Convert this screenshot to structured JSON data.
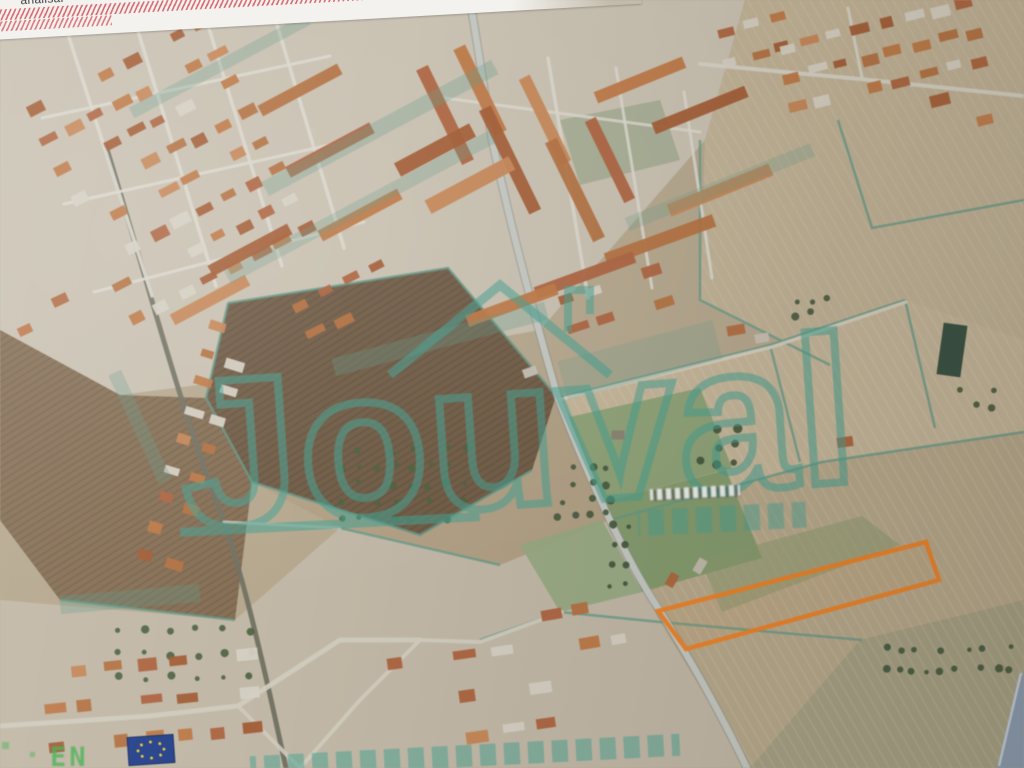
{
  "screen": {
    "toolbar_label": "analisar"
  },
  "watermark": {
    "brand": "Jouval",
    "color": "#3fa392",
    "subtext_legible": false,
    "bottom_row_legible": false
  },
  "map": {
    "corner_mark": "EN",
    "street_label_legible": false,
    "parcel": {
      "points": "658,611 926,542 939,580 686,649",
      "color": "#f5801e"
    },
    "eu_flag": {
      "fill": "#23408f",
      "stars": "#f7d22a"
    },
    "palette": {
      "roofs": [
        "#b0613a",
        "#c1763f",
        "#a55a2f",
        "#c98551",
        "#b66f3b"
      ],
      "light": "#d7d1c3"
    },
    "fields": [
      {
        "points": "0,0 1024,0 1024,768 0,768",
        "fill": "#b7a88c"
      },
      {
        "points": "0,0 745,0 705,140 540,330 330,368 120,395 0,330",
        "fill": "#cbc2b1"
      },
      {
        "points": "745,0 1024,0 1024,340 830,365 700,300 705,140",
        "fill": "#c2b294",
        "pat": "furrows2"
      },
      {
        "points": "252,482 340,528 500,565 610,520 556,396 448,268 228,303 206,398",
        "fill": "#b2a083"
      },
      {
        "points": "228,303 448,268 556,396 532,470 420,535 252,482 206,398",
        "fill": "#6f5a42",
        "pat": "furrows"
      },
      {
        "points": "0,330 120,395 206,398 252,482 235,620 60,600 0,520",
        "fill": "#856c50",
        "pat": "furrows"
      },
      {
        "points": "556,396 770,345 905,300 1024,340 1024,432 822,462 610,520",
        "fill": "#c7b798",
        "pat": "furrows2"
      },
      {
        "points": "610,520 822,462 1024,432 1024,600 860,640 750,768 660,622",
        "fill": "#baa98a",
        "pat": "furrows2"
      },
      {
        "points": "0,600 235,620 340,528 500,565 610,520 660,622 750,768 0,768",
        "fill": "#c3b9a6"
      },
      {
        "points": "860,640 1024,600 1024,768 750,768",
        "fill": "#a8a183",
        "pat": "furrows2"
      }
    ],
    "greens": [
      {
        "points": "565,418 700,388 732,468 602,502",
        "fill": "#8ba173",
        "o": 0.95
      },
      {
        "points": "602,502 726,470 762,558 642,592",
        "fill": "#7f9a69",
        "o": 0.95
      },
      {
        "points": "520,545 602,520 642,592 560,612",
        "fill": "#95aa7e",
        "o": 0.9
      },
      {
        "points": "700,560 862,516 900,545 722,612",
        "fill": "#8a9b6d",
        "o": 0.55
      },
      {
        "points": "560,120 660,100 680,160 580,185",
        "fill": "#7e9a70",
        "o": 0.45
      }
    ],
    "hedges": [
      "228,303 448,268 556,396",
      "228,303 206,398 252,482 420,535 532,470",
      "610,520 822,462 1024,432",
      "556,398 770,345 905,300",
      "770,345 800,462",
      "905,300 935,428",
      "700,140 700,300 830,365",
      "660,622 862,640",
      "340,528 500,565",
      "60,600 235,620",
      "480,640 560,612 660,622",
      "1024,200 872,228 838,120"
    ],
    "roads": [
      {
        "d": "M470,0 C480,60 486,100 492,140 C512,232 536,322 558,398 C586,472 626,560 658,608 C692,662 720,712 747,768",
        "w": 9,
        "c": "#8d9189",
        "o": 0.55
      },
      {
        "d": "M470,0 C480,60 486,100 492,140 C512,232 536,322 558,398 C586,472 626,560 658,608 C692,662 720,712 747,768",
        "w": 6.5,
        "c": "#c6c9c3",
        "o": 1
      },
      {
        "d": "M106,146 C142,262 178,402 224,522 C243,578 258,642 272,704 L286,768",
        "w": 5,
        "c": "#70705f",
        "o": 0.95
      },
      {
        "d": "M558,400 L772,347 L906,302",
        "w": 3.5,
        "c": "#d8d2c2",
        "o": 0.9
      },
      {
        "d": "M0,726 L150,716 L238,706 L340,640 L420,640",
        "w": 5,
        "c": "#d2ccbe",
        "o": 0.95
      },
      {
        "d": "M420,640 L480,642 L562,612",
        "w": 4,
        "c": "#d2ccbe",
        "o": 0.95
      },
      {
        "d": "M300,768 L360,700 L420,640",
        "w": 4,
        "c": "#d2ccbe",
        "o": 0.95
      },
      {
        "d": "M238,706 L300,768",
        "w": 4,
        "c": "#d2ccbe",
        "o": 0.9
      },
      {
        "d": "M700,64 L870,80 L1024,96",
        "w": 4,
        "c": "#d8d4c8",
        "o": 0.9
      },
      {
        "d": "M862,78 L848,8",
        "w": 3,
        "c": "#d8d4c8",
        "o": 0.9
      },
      {
        "d": "M66,28 L152,296",
        "w": 3.5,
        "c": "#ddd9ce",
        "o": 0.9
      },
      {
        "d": "M134,18 L216,286",
        "w": 3.5,
        "c": "#ddd9ce",
        "o": 0.9
      },
      {
        "d": "M204,12 L282,266",
        "w": 3.5,
        "c": "#ddd9ce",
        "o": 0.9
      },
      {
        "d": "M272,8 L344,248",
        "w": 3.5,
        "c": "#ddd9ce",
        "o": 0.9
      },
      {
        "d": "M42,118 L330,56",
        "w": 3,
        "c": "#ddd9ce",
        "o": 0.9
      },
      {
        "d": "M64,204 L352,140",
        "w": 3,
        "c": "#ddd9ce",
        "o": 0.9
      },
      {
        "d": "M94,292 L364,222",
        "w": 3,
        "c": "#ddd9ce",
        "o": 0.9
      },
      {
        "d": "M548,58 L588,298",
        "w": 3.5,
        "c": "#ddd9ce",
        "o": 0.9
      },
      {
        "d": "M616,68 L652,288",
        "w": 3,
        "c": "#ddd9ce",
        "o": 0.9
      },
      {
        "d": "M684,92 L712,278",
        "w": 3,
        "c": "#ddd9ce",
        "o": 0.9
      },
      {
        "d": "M430,96 L700,132",
        "w": 3,
        "c": "#ddd9ce",
        "o": 0.85
      },
      {
        "d": "M224,522 L340,528",
        "w": 3,
        "c": "#cfcabc",
        "o": 0.85
      }
    ],
    "groves": [
      {
        "x": 340,
        "y": 450,
        "cols": 8,
        "rows": 5,
        "dx": 18,
        "dy": 17,
        "r": 2.8,
        "fill": "#4a5f3a"
      },
      {
        "x": 560,
        "y": 470,
        "cols": 4,
        "rows": 4,
        "dx": 16,
        "dy": 15,
        "r": 3.2,
        "fill": "#41573a"
      },
      {
        "x": 885,
        "y": 648,
        "cols": 10,
        "rows": 2,
        "dx": 14,
        "dy": 22,
        "r": 3,
        "fill": "#3f5638"
      },
      {
        "x": 120,
        "y": 630,
        "cols": 6,
        "rows": 3,
        "dx": 26,
        "dy": 24,
        "r": 3,
        "fill": "#47603c"
      },
      {
        "x": 700,
        "y": 430,
        "cols": 3,
        "rows": 3,
        "dx": 18,
        "dy": 16,
        "r": 3.5,
        "fill": "#3e5336"
      },
      {
        "x": 960,
        "y": 390,
        "cols": 3,
        "rows": 2,
        "dx": 16,
        "dy": 16,
        "r": 3,
        "fill": "#44563b"
      },
      {
        "x": 612,
        "y": 525,
        "cols": 2,
        "rows": 4,
        "dx": 14,
        "dy": 20,
        "r": 3,
        "fill": "#3e5336"
      },
      {
        "x": 795,
        "y": 300,
        "cols": 3,
        "rows": 2,
        "dx": 15,
        "dy": 14,
        "r": 3,
        "fill": "#44563b"
      }
    ],
    "clusters": [
      {
        "cx": 170,
        "cy": 170,
        "cols": 8,
        "rows": 8,
        "dx": 27,
        "dy": 33,
        "bw": 16,
        "bh": 9,
        "a": -27
      },
      {
        "cx": 880,
        "cy": 55,
        "cols": 8,
        "rows": 3,
        "dx": 27,
        "dy": 30,
        "bw": 15,
        "bh": 9,
        "a": -14
      },
      {
        "cx": 755,
        "cy": 40,
        "cols": 3,
        "rows": 2,
        "dx": 28,
        "dy": 30,
        "bw": 15,
        "bh": 9,
        "a": -14
      },
      {
        "cx": 196,
        "cy": 445,
        "cols": 2,
        "rows": 9,
        "dx": 27,
        "dy": 30,
        "bw": 15,
        "bh": 9,
        "a": 17
      },
      {
        "cx": 150,
        "cy": 700,
        "cols": 7,
        "rows": 3,
        "dx": 33,
        "dy": 38,
        "bw": 17,
        "bh": 10,
        "a": -6
      },
      {
        "cx": 470,
        "cy": 695,
        "cols": 5,
        "rows": 3,
        "dx": 35,
        "dy": 40,
        "bw": 18,
        "bh": 10,
        "a": -8
      },
      {
        "cx": 585,
        "cy": 625,
        "cols": 3,
        "rows": 2,
        "dx": 33,
        "dy": 36,
        "bw": 17,
        "bh": 10,
        "a": -10
      },
      {
        "cx": 345,
        "cy": 300,
        "cols": 4,
        "rows": 2,
        "dx": 28,
        "dy": 32,
        "bw": 16,
        "bh": 9,
        "a": -27
      },
      {
        "cx": 615,
        "cy": 300,
        "cols": 4,
        "rows": 2,
        "dx": 30,
        "dy": 32,
        "bw": 17,
        "bh": 9,
        "a": -18
      }
    ],
    "bars": [
      {
        "x": 445,
        "y": 115,
        "l": 105,
        "t": 13,
        "a": 64
      },
      {
        "x": 480,
        "y": 90,
        "l": 95,
        "t": 13,
        "a": 64
      },
      {
        "x": 510,
        "y": 160,
        "l": 115,
        "t": 13,
        "a": 64
      },
      {
        "x": 545,
        "y": 120,
        "l": 95,
        "t": 12,
        "a": 64
      },
      {
        "x": 575,
        "y": 190,
        "l": 110,
        "t": 13,
        "a": 64
      },
      {
        "x": 610,
        "y": 160,
        "l": 90,
        "t": 12,
        "a": 64
      },
      {
        "x": 640,
        "y": 80,
        "l": 95,
        "t": 12,
        "a": -22
      },
      {
        "x": 700,
        "y": 110,
        "l": 100,
        "t": 12,
        "a": -22
      },
      {
        "x": 720,
        "y": 190,
        "l": 110,
        "t": 13,
        "a": -22
      },
      {
        "x": 660,
        "y": 240,
        "l": 115,
        "t": 13,
        "a": -20
      },
      {
        "x": 585,
        "y": 275,
        "l": 105,
        "t": 12,
        "a": -20
      },
      {
        "x": 512,
        "y": 305,
        "l": 95,
        "t": 12,
        "a": -20
      },
      {
        "x": 435,
        "y": 150,
        "l": 85,
        "t": 15,
        "a": -28
      },
      {
        "x": 470,
        "y": 185,
        "l": 95,
        "t": 15,
        "a": -28
      },
      {
        "x": 300,
        "y": 90,
        "l": 90,
        "t": 12,
        "a": -28
      },
      {
        "x": 330,
        "y": 150,
        "l": 95,
        "t": 12,
        "a": -28
      },
      {
        "x": 360,
        "y": 215,
        "l": 90,
        "t": 12,
        "a": -28
      },
      {
        "x": 250,
        "y": 250,
        "l": 90,
        "t": 12,
        "a": -28
      },
      {
        "x": 210,
        "y": 300,
        "l": 85,
        "t": 12,
        "a": -28
      }
    ],
    "singles": [
      {
        "x": 952,
        "y": 350,
        "w": 24,
        "h": 52,
        "a": 8,
        "c": "#2e4b3c"
      },
      {
        "x": 736,
        "y": 330,
        "w": 18,
        "h": 10,
        "a": -10,
        "c": "#b56a3c"
      },
      {
        "x": 762,
        "y": 338,
        "w": 14,
        "h": 9,
        "a": -10,
        "c": "#c8c2b4"
      },
      {
        "x": 845,
        "y": 442,
        "w": 16,
        "h": 10,
        "a": -8,
        "c": "#b06036"
      },
      {
        "x": 700,
        "y": 566,
        "w": 15,
        "h": 9,
        "a": -60,
        "c": "#c4bdb0"
      },
      {
        "x": 672,
        "y": 580,
        "w": 14,
        "h": 9,
        "a": -60,
        "c": "#b26438"
      },
      {
        "x": 618,
        "y": 435,
        "w": 13,
        "h": 9,
        "a": 0,
        "c": "#8a8270"
      },
      {
        "x": 530,
        "y": 372,
        "w": 14,
        "h": 9,
        "a": -20,
        "c": "#c9c3b5"
      },
      {
        "x": 60,
        "y": 300,
        "w": 16,
        "h": 10,
        "a": -25,
        "c": "#b3663a"
      },
      {
        "x": 25,
        "y": 330,
        "w": 14,
        "h": 9,
        "a": -25,
        "c": "#c0723f"
      },
      {
        "x": 940,
        "y": 100,
        "w": 20,
        "h": 12,
        "a": -14,
        "c": "#a95e31"
      },
      {
        "x": 985,
        "y": 120,
        "w": 16,
        "h": 10,
        "a": -14,
        "c": "#c57a44"
      }
    ],
    "washes": [
      {
        "x": 250,
        "y": 120,
        "w": 260,
        "h": 16,
        "a": -28,
        "o": 0.3
      },
      {
        "x": 210,
        "y": 200,
        "w": 300,
        "h": 14,
        "a": -28,
        "o": 0.28
      },
      {
        "x": 330,
        "y": 330,
        "w": 220,
        "h": 18,
        "a": -15,
        "o": 0.3
      },
      {
        "x": 560,
        "y": 340,
        "w": 160,
        "h": 40,
        "a": -15,
        "o": 0.22
      },
      {
        "x": 80,
        "y": 420,
        "w": 120,
        "h": 14,
        "a": 65,
        "o": 0.3
      },
      {
        "x": 60,
        "y": 590,
        "w": 140,
        "h": 18,
        "a": -5,
        "o": 0.3
      },
      {
        "x": 620,
        "y": 180,
        "w": 200,
        "h": 14,
        "a": -22,
        "o": 0.25
      },
      {
        "x": 120,
        "y": 60,
        "w": 200,
        "h": 12,
        "a": -28,
        "o": 0.3
      },
      {
        "x": 250,
        "y": 745,
        "w": 430,
        "h": 22,
        "a": -3,
        "o": 0.5,
        "blocks": true
      }
    ]
  }
}
